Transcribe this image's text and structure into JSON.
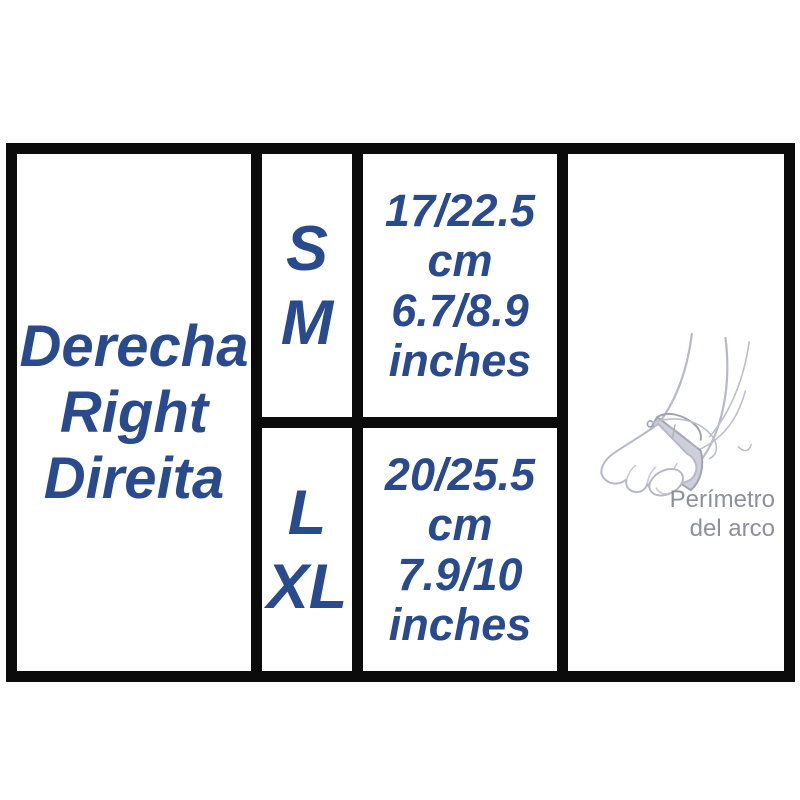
{
  "colors": {
    "accent-blue": "#2a4a8e",
    "caption-gray": "#8d909b",
    "border-black": "#0b0b0b",
    "art-outline": "#b6b9c5",
    "art-band-fill": "#cdd0da",
    "art-band-stroke": "#a0a4b2"
  },
  "side_panel": {
    "labels": [
      "Derecha",
      "Right",
      "Direita"
    ]
  },
  "size_rows": [
    {
      "sizes": [
        "S",
        "M"
      ],
      "measurement_lines": [
        "17/22.5",
        "cm",
        "6.7/8.9",
        "inches"
      ]
    },
    {
      "sizes": [
        "L",
        "XL"
      ],
      "measurement_lines": [
        "20/25.5",
        "cm",
        "7.9/10",
        "inches"
      ]
    }
  ],
  "illustration": {
    "icon": "foot-arch-brace-icon",
    "caption_lines": [
      "Perímetro",
      "del arco"
    ]
  }
}
